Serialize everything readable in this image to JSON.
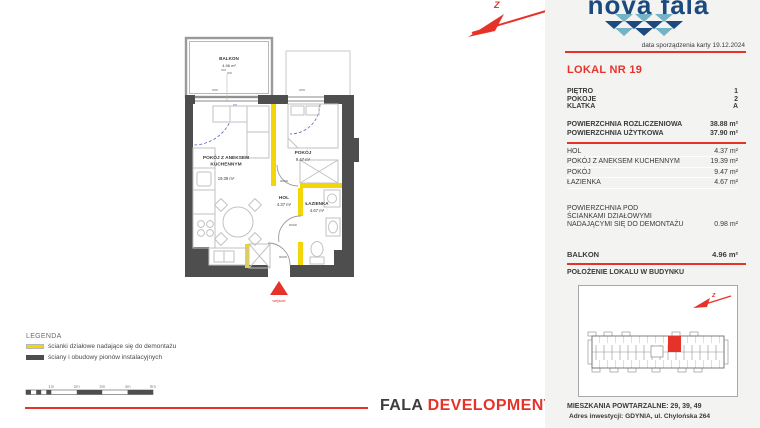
{
  "brand": {
    "logo_text": "nova fala",
    "footer_dark": "FALA",
    "footer_red": "DEVELOPMENT 2"
  },
  "compass_label": "Z",
  "panel": {
    "date_note": "data sporządzenia karty 19.12.2024",
    "unit_title": "LOKAL NR 19",
    "attrs": [
      {
        "label": "PIĘTRO",
        "value": "1"
      },
      {
        "label": "POKOJE",
        "value": "2"
      },
      {
        "label": "KLATKA",
        "value": "A"
      }
    ],
    "areas_main": [
      {
        "label": "POWIERZCHNIA ROZLICZENIOWA",
        "value": "38.88 m²"
      },
      {
        "label": "POWIERZCHNIA UŻYTKOWA",
        "value": "37.90 m²"
      }
    ],
    "rooms": [
      {
        "label": "HOL",
        "value": "4.37 m²"
      },
      {
        "label": "POKÓJ Z ANEKSEM KUCHENNYM",
        "value": "19.39 m²"
      },
      {
        "label": "POKÓJ",
        "value": "9.47 m²"
      },
      {
        "label": "ŁAZIENKA",
        "value": "4.67 m²"
      }
    ],
    "demontaz": {
      "line1": "POWIERZCHNIA POD",
      "line2": "ŚCIANKAMI DZIAŁOWYMI",
      "line3": "NADAJĄCYMI SIĘ DO DEMONTAŻU",
      "value": "0.98 m²"
    },
    "balkon": {
      "label": "BALKON",
      "value": "4.96 m²"
    },
    "location_title": "POŁOŻENIE LOKALU W BUDYNKU",
    "repeat_note": "MIESZKANIA POWTARZALNE: 29, 39, 49",
    "address": "Adres inwestycji: GDYNIA, ul. Chylońska 264"
  },
  "plan": {
    "balkon_name": "BALKON",
    "balkon_area": "4.96 m²",
    "living_name1": "POKÓJ Z ANEKSEM",
    "living_name2": "KUCHENNYM",
    "living_area": "19.39 m²",
    "bedroom_name": "POKÓJ",
    "bedroom_area": "9.47 m²",
    "hol_name": "HOL",
    "hol_area": "4.37 m²",
    "bath_name": "ŁAZIENKA",
    "bath_area": "4.67 m²",
    "entrance_label": "wejście",
    "door_size": "90/200"
  },
  "legend": {
    "title": "LEGENDA",
    "items": [
      {
        "label": "ścianki działowe nadające się do demontażu"
      },
      {
        "label": "ściany i obudowy pionów instalacyjnych"
      }
    ],
    "scale_ticks": [
      "1m",
      "2m",
      "3m",
      "4m",
      "5m"
    ]
  },
  "colors": {
    "red": "#e6332a",
    "navy": "#1c4a7e",
    "wave_light": "#74b2c6",
    "wall_dark": "#4e4e4e",
    "wall_yellow": "#f2d60a",
    "panel_bg": "#f3f3f2"
  }
}
